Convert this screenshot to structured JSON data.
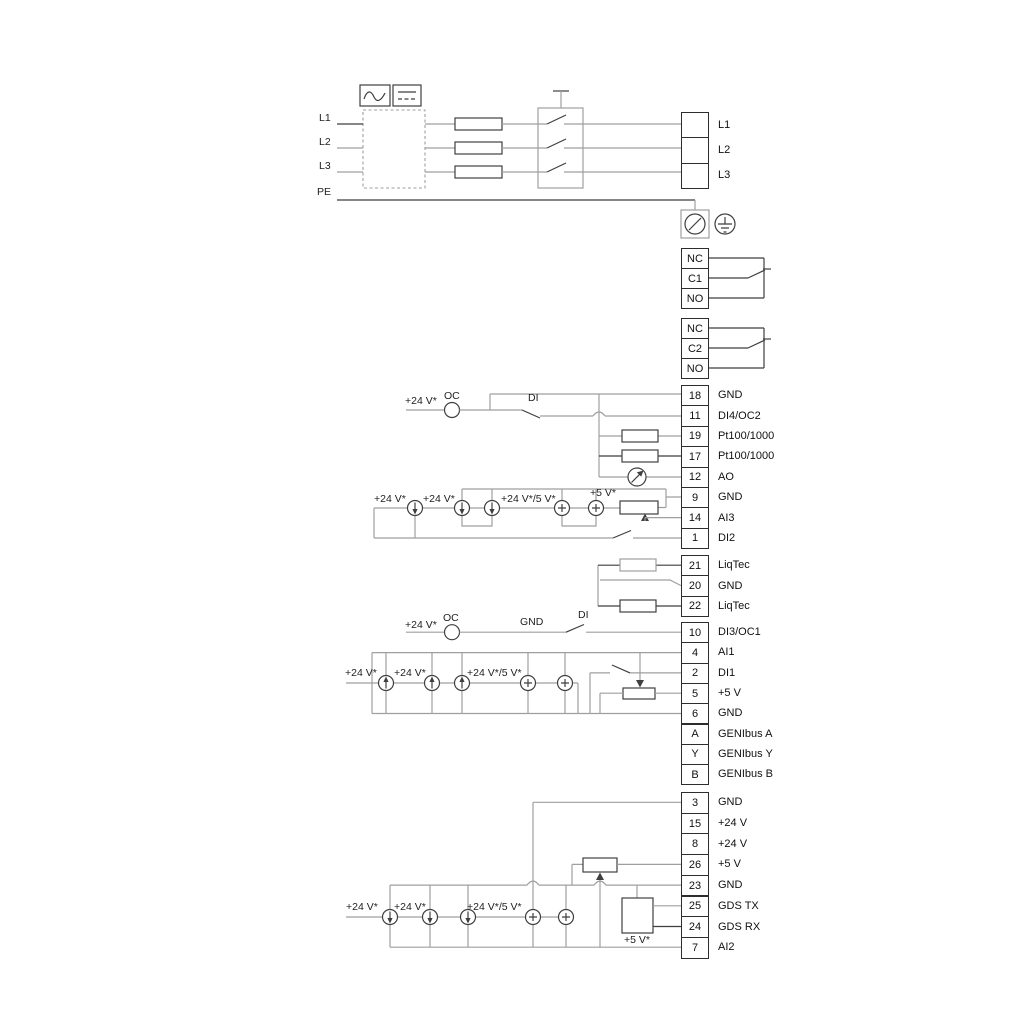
{
  "colors": {
    "background": "#ffffff",
    "wire_dark": "#3f3f3f",
    "wire_grey": "#9f9f9f",
    "text": "#111111"
  },
  "power_input": {
    "source_labels": [
      "L1",
      "L2",
      "L3"
    ],
    "pe_label": "PE",
    "output_block": [
      {
        "n": "",
        "l": "L1"
      },
      {
        "n": "",
        "l": "L2"
      },
      {
        "n": "",
        "l": "L3"
      }
    ]
  },
  "relays": {
    "relay1": [
      {
        "n": "NC",
        "l": ""
      },
      {
        "n": "C1",
        "l": ""
      },
      {
        "n": "NO",
        "l": ""
      }
    ],
    "relay2": [
      {
        "n": "NC",
        "l": ""
      },
      {
        "n": "C2",
        "l": ""
      },
      {
        "n": "NO",
        "l": ""
      }
    ]
  },
  "strips": {
    "io_top": [
      {
        "n": "18",
        "l": "GND"
      },
      {
        "n": "11",
        "l": "DI4/OC2"
      },
      {
        "n": "19",
        "l": "Pt100/1000"
      },
      {
        "n": "17",
        "l": "Pt100/1000"
      },
      {
        "n": "12",
        "l": "AO"
      },
      {
        "n": "9",
        "l": "GND"
      },
      {
        "n": "14",
        "l": "AI3"
      },
      {
        "n": "1",
        "l": "DI2"
      }
    ],
    "liqtec": [
      {
        "n": "21",
        "l": "LiqTec"
      },
      {
        "n": "20",
        "l": "GND"
      },
      {
        "n": "22",
        "l": "LiqTec"
      }
    ],
    "io_mid": [
      {
        "n": "10",
        "l": "DI3/OC1"
      },
      {
        "n": "4",
        "l": "AI1"
      },
      {
        "n": "2",
        "l": "DI1"
      },
      {
        "n": "5",
        "l": "+5 V"
      },
      {
        "n": "6",
        "l": "GND"
      },
      {
        "n": "A",
        "l": "GENIbus A"
      },
      {
        "n": "Y",
        "l": "GENIbus Y"
      },
      {
        "n": "B",
        "l": "GENIbus B"
      }
    ],
    "io_bottom": [
      {
        "n": "3",
        "l": "GND"
      },
      {
        "n": "15",
        "l": "+24 V"
      },
      {
        "n": "8",
        "l": "+24 V"
      },
      {
        "n": "26",
        "l": "+5 V"
      },
      {
        "n": "23",
        "l": "GND"
      },
      {
        "n": "25",
        "l": "GDS TX"
      },
      {
        "n": "24",
        "l": "GDS RX"
      },
      {
        "n": "7",
        "l": "AI2"
      }
    ]
  },
  "wire_labels": [
    {
      "t": "L1",
      "x": 319,
      "y": 112
    },
    {
      "t": "L2",
      "x": 319,
      "y": 136
    },
    {
      "t": "L3",
      "x": 319,
      "y": 160
    },
    {
      "t": "PE",
      "x": 317,
      "y": 186
    },
    {
      "t": "+24 V*",
      "x": 405,
      "y": 395
    },
    {
      "t": "OC",
      "x": 444,
      "y": 390
    },
    {
      "t": "DI",
      "x": 528,
      "y": 392
    },
    {
      "t": "+24 V*",
      "x": 374,
      "y": 493
    },
    {
      "t": "+24 V*",
      "x": 423,
      "y": 493
    },
    {
      "t": "+24 V*/5 V*",
      "x": 501,
      "y": 493
    },
    {
      "t": "+5 V*",
      "x": 590,
      "y": 487
    },
    {
      "t": "+24 V*",
      "x": 405,
      "y": 619
    },
    {
      "t": "OC",
      "x": 443,
      "y": 612
    },
    {
      "t": "GND",
      "x": 520,
      "y": 616
    },
    {
      "t": "DI",
      "x": 578,
      "y": 609
    },
    {
      "t": "+24 V*",
      "x": 345,
      "y": 667
    },
    {
      "t": "+24 V*",
      "x": 394,
      "y": 667
    },
    {
      "t": "+24 V*/5 V*",
      "x": 467,
      "y": 667
    },
    {
      "t": "+24 V*",
      "x": 346,
      "y": 901
    },
    {
      "t": "+24 V*",
      "x": 394,
      "y": 901
    },
    {
      "t": "+24 V*/5 V*",
      "x": 467,
      "y": 901
    },
    {
      "t": "+5 V*",
      "x": 624,
      "y": 934
    }
  ]
}
